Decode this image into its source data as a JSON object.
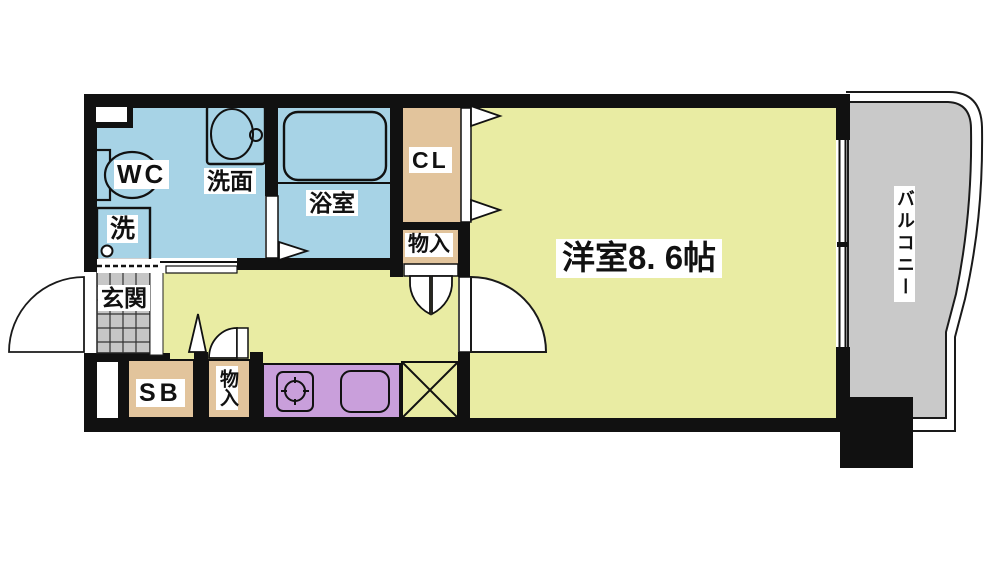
{
  "title": "1K apartment floor plan",
  "labels": {
    "wc": "WC",
    "washstand": "洗面",
    "bathroom": "浴室",
    "washer": "洗",
    "closet": "CL",
    "storage_upper": "物入",
    "storage_lower": "物入",
    "entrance": "玄関",
    "shoe_box": "SB",
    "western_room": "洋室8. 6帖",
    "balcony": "バルコニー"
  },
  "colors": {
    "wall": "#111111",
    "room_yellow": "#e9eca3",
    "wet_blue": "#a7d3e6",
    "closet_tan": "#e2c49c",
    "kitchen_purple": "#c99fdb",
    "balcony_gray": "#c9c9c9",
    "tile_gray": "#c6c6c6",
    "label_bg": "#ffffff",
    "line": "#1a1a1a"
  }
}
